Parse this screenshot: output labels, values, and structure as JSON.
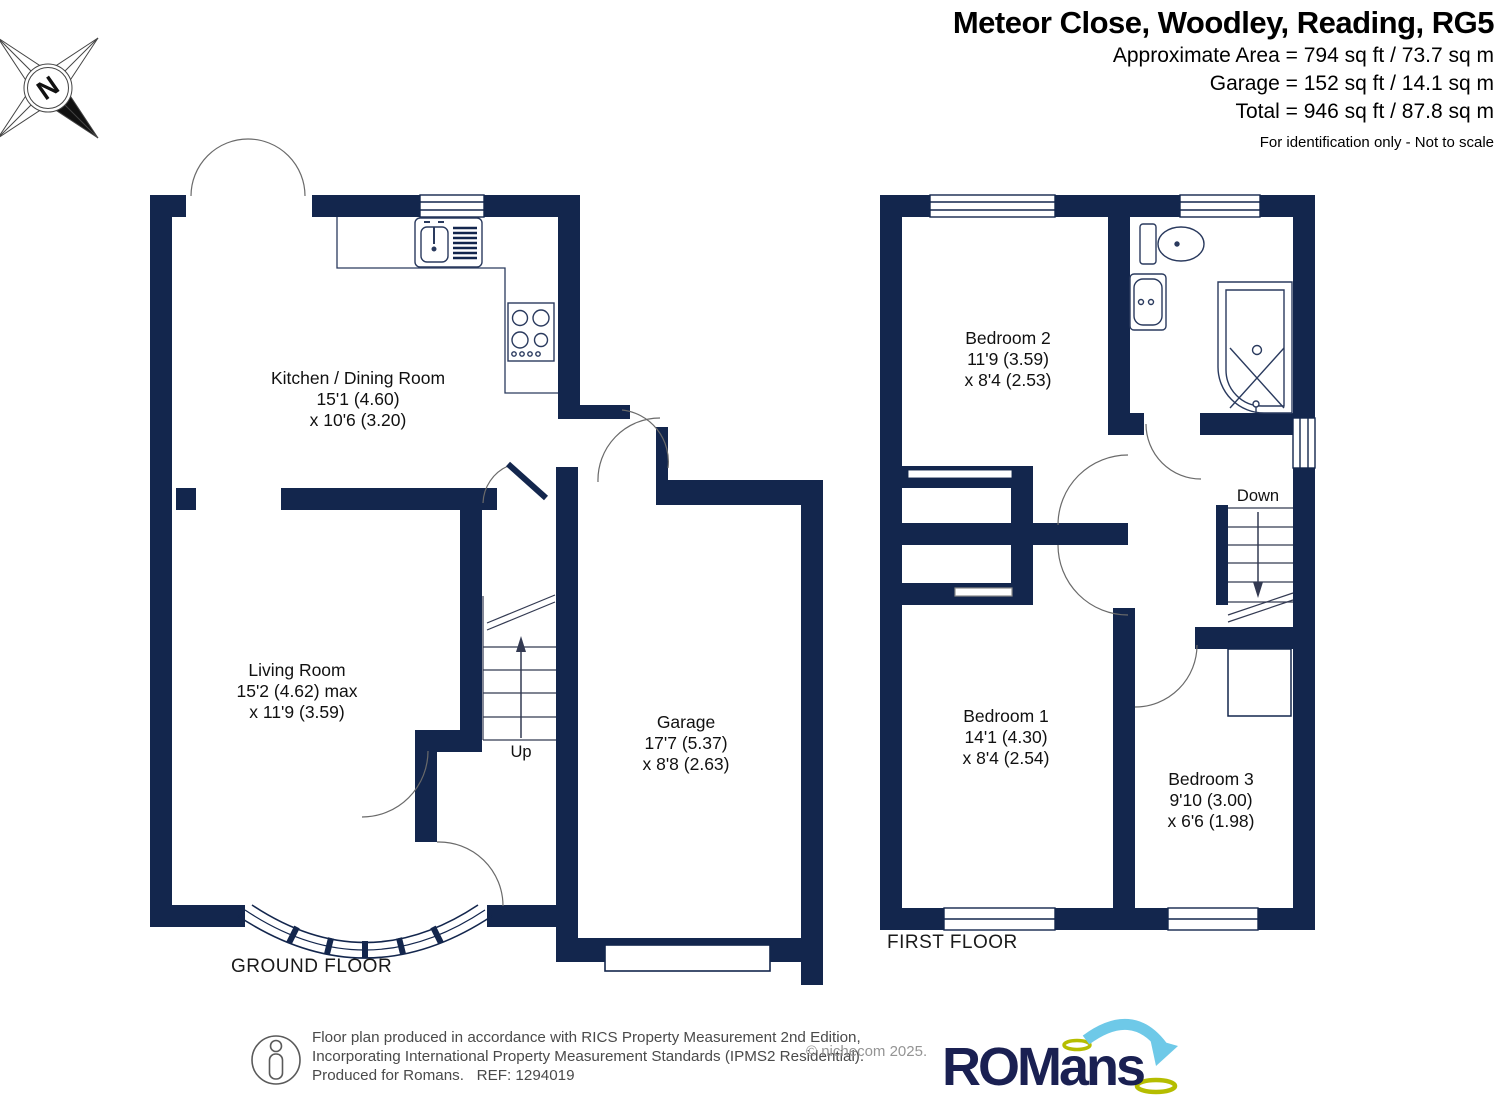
{
  "header": {
    "title": "Meteor Close, Woodley, Reading, RG5",
    "area_lines": [
      "Approximate Area = 794 sq ft / 73.7 sq m",
      "Garage = 152 sq ft / 14.1 sq m",
      "Total = 946 sq ft / 87.8 sq m"
    ],
    "disclaimer": "For identification only - Not to scale"
  },
  "compass": {
    "label": "N"
  },
  "floors": [
    {
      "name": "GROUND FLOOR",
      "stairs_label": "Up",
      "rooms": [
        {
          "label": "Kitchen / Dining Room",
          "dim1": "15'1 (4.60)",
          "dim2": "x 10'6 (3.20)"
        },
        {
          "label": "Living Room",
          "dim1": "15'2 (4.62) max",
          "dim2": "x 11'9 (3.59)"
        },
        {
          "label": "Garage",
          "dim1": "17'7 (5.37)",
          "dim2": "x 8'8 (2.63)"
        }
      ]
    },
    {
      "name": "FIRST FLOOR",
      "stairs_label": "Down",
      "rooms": [
        {
          "label": "Bedroom 2",
          "dim1": "11'9 (3.59)",
          "dim2": "x 8'4 (2.53)"
        },
        {
          "label": "Bedroom 1",
          "dim1": "14'1 (4.30)",
          "dim2": "x 8'4 (2.54)"
        },
        {
          "label": "Bedroom 3",
          "dim1": "9'10 (3.00)",
          "dim2": "x 6'6 (1.98)"
        }
      ]
    }
  ],
  "footer": {
    "line1": "Floor plan produced in accordance with RICS Property Measurement 2nd Edition,",
    "line2": "Incorporating International Property Measurement Standards (IPMS2 Residential).",
    "line3": "Produced for Romans.   REF: 1294019",
    "copyright": "© nichecom 2025.",
    "logo_text": "ROMans"
  },
  "colors": {
    "wall_navy": "#13264d",
    "logo_navy": "#1a2052",
    "logo_blue": "#6ec9e8",
    "logo_green": "#b5bd00"
  }
}
